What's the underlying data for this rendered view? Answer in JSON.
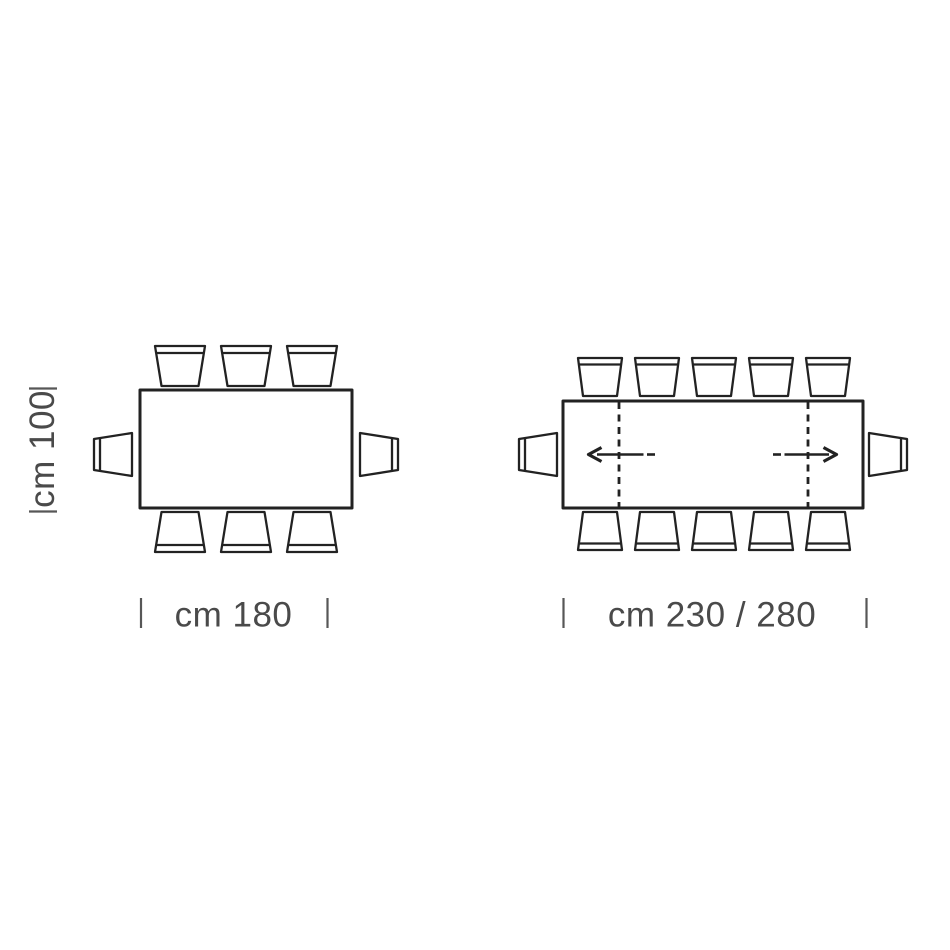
{
  "colors": {
    "background": "#ffffff",
    "line_color": "#222222",
    "text_color": "#4a4a4a",
    "tick_color": "#575757"
  },
  "diagrams": {
    "fixed_table": {
      "depth_label": "cm 100",
      "width_label": "cm 180",
      "chairs": {
        "top": 3,
        "bottom": 3,
        "left": 1,
        "right": 1,
        "total": 8
      }
    },
    "extendable_table": {
      "width_label": "cm 230 / 280",
      "chairs": {
        "top": 5,
        "bottom": 5,
        "left": 1,
        "right": 1,
        "total": 12
      },
      "extension_leaves": 2,
      "extension_arrows": 2
    }
  }
}
